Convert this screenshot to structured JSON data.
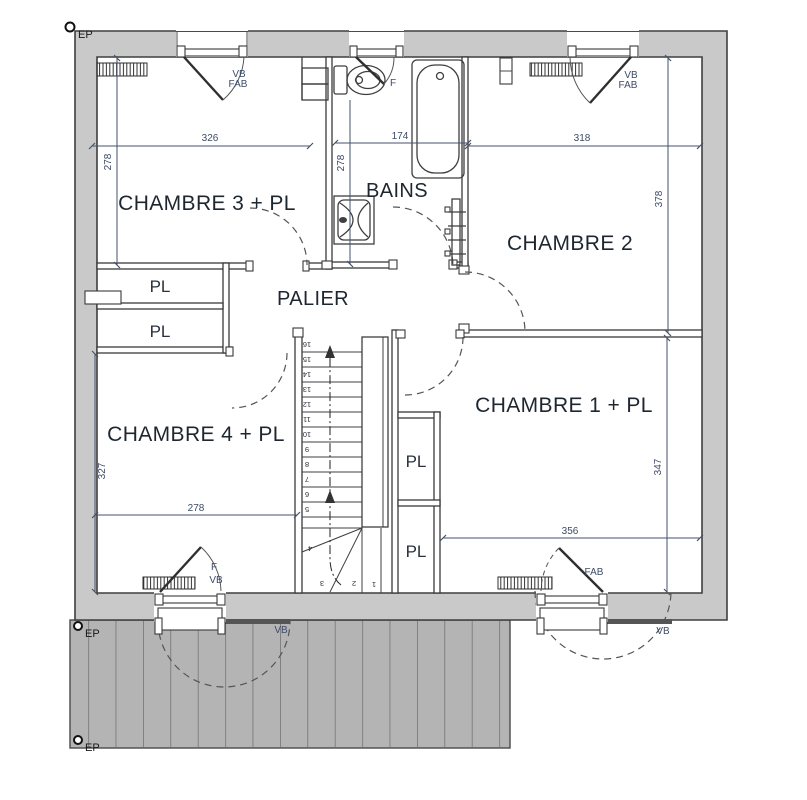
{
  "title": "floor-plan-etage",
  "colors": {
    "wall_fill": "#c9c9c9",
    "deck_fill": "#b4b4b4",
    "line": "#3a3a3a",
    "room_label": "#1e2630",
    "dim_label": "#3c4a66"
  },
  "rooms": {
    "chambre3": "CHAMBRE 3 + PL",
    "bains": "BAINS",
    "chambre2": "CHAMBRE 2",
    "palier": "PALIER",
    "chambre4": "CHAMBRE 4 + PL",
    "chambre1": "CHAMBRE 1 + PL",
    "pl": "PL"
  },
  "dims": {
    "chambre3_w": "326",
    "bains_w": "174",
    "chambre2_w": "318",
    "chambre3_h": "278",
    "bains_h": "278",
    "chambre2_h": "378",
    "chambre1_h": "347",
    "chambre1_w": "356",
    "chambre4_h": "327",
    "chambre4_w": "278"
  },
  "ann": {
    "ep": "EP",
    "vb": "VB",
    "fab": "FAB",
    "f": "F"
  },
  "stairs": {
    "numbers": [
      "1",
      "2",
      "3",
      "4",
      "5",
      "6",
      "7",
      "8",
      "9",
      "10",
      "11",
      "12",
      "13",
      "14",
      "15",
      "16"
    ]
  }
}
